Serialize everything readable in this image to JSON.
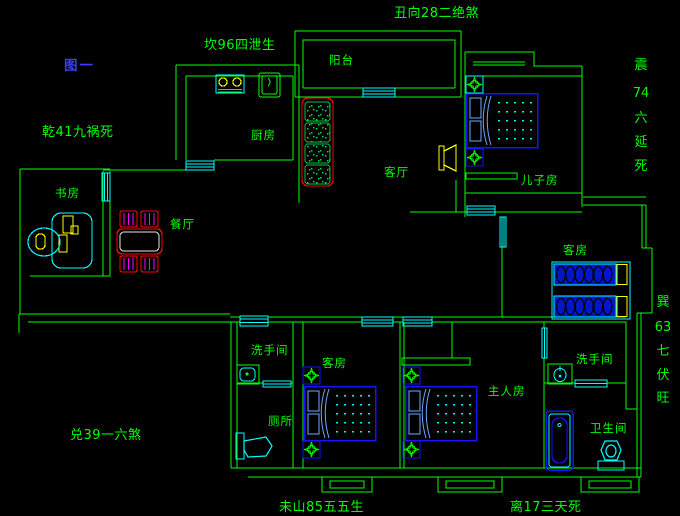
{
  "figure_label": "图一",
  "fengshui": {
    "top": "丑向28二绝煞",
    "top_left": "坎96四泄生",
    "left_upper": "乾41九祸死",
    "left_lower": "兑39一六煞",
    "bottom_left": "未山85五五生",
    "bottom_right": "离17三天死",
    "right_upper": [
      "震",
      "74",
      "六",
      "延",
      "死"
    ],
    "right_lower": [
      "巽",
      "63",
      "七",
      "伏",
      "旺"
    ]
  },
  "rooms": {
    "balcony": "阳台",
    "kitchen": "厨房",
    "study": "书房",
    "dining": "餐厅",
    "living": "客厅",
    "kids": "儿子房",
    "guest_top": "客房",
    "guest_bottom": "客房",
    "washroom_left": "洗手间",
    "toilet": "厕所",
    "master": "主人房",
    "washroom_right": "洗手间",
    "bathroom": "卫生间"
  },
  "colors": {
    "background": "#000000",
    "wall_green": "#00ff00",
    "window_cyan": "#00ffff",
    "furniture_blue": "#0000ff",
    "accent_yellow": "#ffff00",
    "sofa_red": "#ff0000",
    "chair_magenta": "#ff00ff",
    "figure_blue": "#3c3cff"
  }
}
